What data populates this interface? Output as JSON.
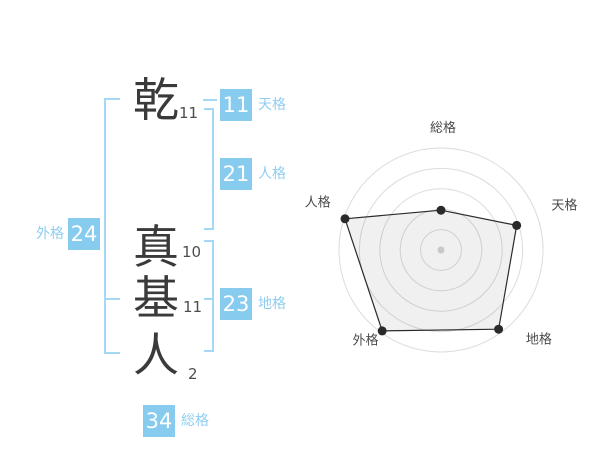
{
  "name": {
    "surname": [
      {
        "char": "乾",
        "strokes": "11"
      }
    ],
    "given_name": [
      {
        "char": "真",
        "strokes": "10"
      },
      {
        "char": "基",
        "strokes": "11"
      },
      {
        "char": "人",
        "strokes": "2"
      }
    ]
  },
  "kaku": {
    "tenkaku": {
      "value": "11",
      "label": "天格"
    },
    "jinkaku": {
      "value": "21",
      "label": "人格"
    },
    "chikaku": {
      "value": "23",
      "label": "地格"
    },
    "gaikaku": {
      "value": "24",
      "label": "外格"
    },
    "soukaku": {
      "value": "34",
      "label": "総格"
    }
  },
  "colors": {
    "badge_bg": "#87cbee",
    "badge_text": "#ffffff",
    "kaku_label_text": "#8fcef2",
    "bracket_line": "#a5d8f4",
    "kanji_text": "#3a3a3a",
    "stroke_count_text": "#4d4d4d",
    "chart_ring": "#dcdcdc",
    "chart_fill": "rgba(0,0,0,0.06)",
    "chart_stroke": "#2a2a2a",
    "chart_center_dot": "#c8c8c8",
    "chart_label": "#4a4a4a"
  },
  "chart_data": {
    "type": "radar",
    "title": "",
    "axes": [
      "総格",
      "天格",
      "地格",
      "外格",
      "人格"
    ],
    "axes_angles_deg": [
      90,
      18,
      -54,
      -126,
      162
    ],
    "values_fraction_of_max": [
      0.39,
      0.78,
      0.96,
      0.98,
      0.99
    ],
    "ring_count": 5,
    "grid": "concentric-circles",
    "legend": "none"
  }
}
